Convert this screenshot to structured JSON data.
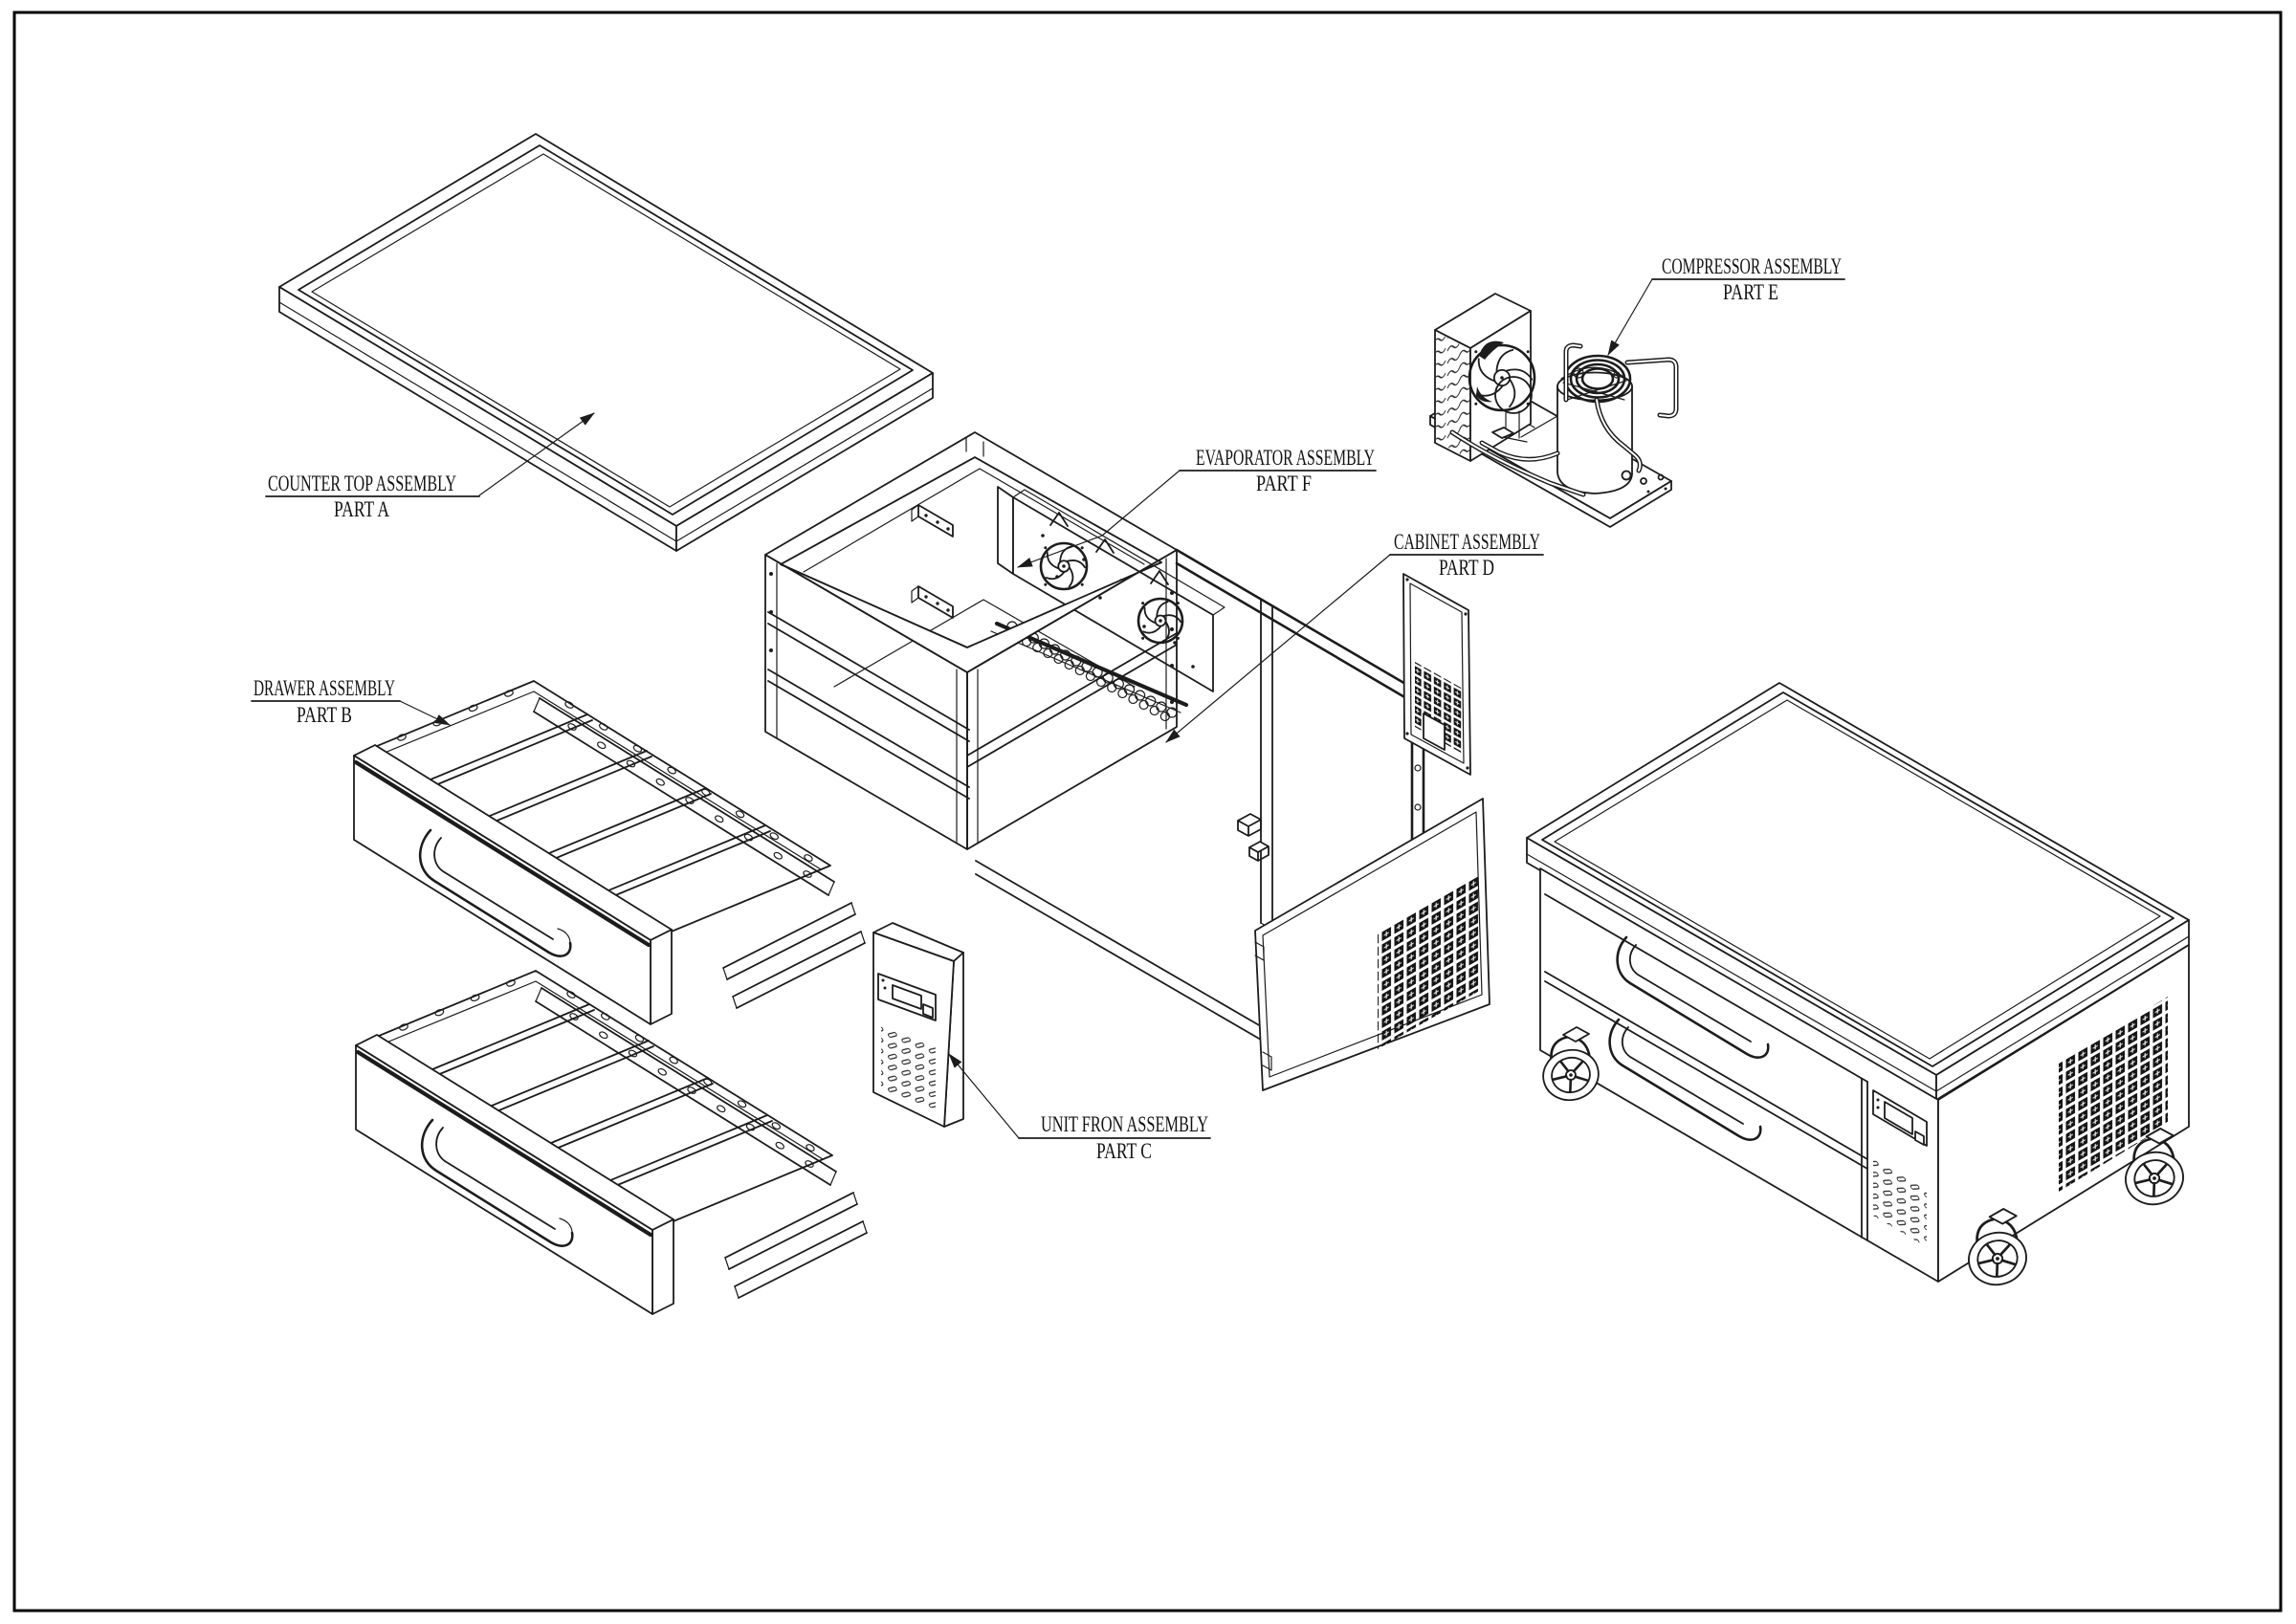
{
  "page": {
    "background": "#ffffff",
    "frame_color": "#000000",
    "line_color": "#1c1c1c"
  },
  "callouts": {
    "part_a": {
      "title": "COUNTER TOP ASSEMBLY",
      "part": "PART A"
    },
    "part_b": {
      "title": "DRAWER ASSEMBLY",
      "part": "PART B"
    },
    "part_c": {
      "title": "UNIT FRON ASSEMBLY",
      "part": "PART C"
    },
    "part_d": {
      "title": "CABINET ASSEMBLY",
      "part": "PART D"
    },
    "part_e": {
      "title": "COMPRESSOR ASSEMBLY",
      "part": "PART E"
    },
    "part_f": {
      "title": "EVAPORATOR ASSEMBLY",
      "part": "PART F"
    }
  }
}
